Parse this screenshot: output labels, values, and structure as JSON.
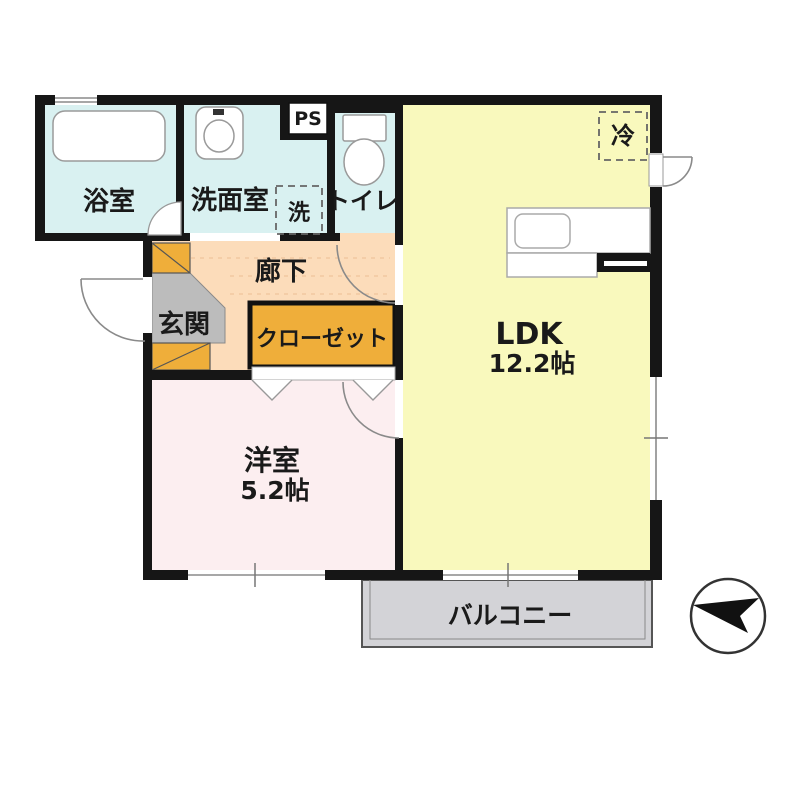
{
  "plan": {
    "rooms": {
      "bath": {
        "label": "浴室"
      },
      "washroom": {
        "label": "洗面室"
      },
      "laundry": {
        "label": "洗"
      },
      "pipe_space": {
        "label": "PS"
      },
      "toilet": {
        "label": "トイレ"
      },
      "refrigerator": {
        "label": "冷"
      },
      "ldk": {
        "label": "LDK",
        "size": "12.2帖"
      },
      "hallway": {
        "label": "廊下"
      },
      "entrance": {
        "label": "玄関"
      },
      "closet": {
        "label": "クローゼット"
      },
      "western_room": {
        "label": "洋室",
        "size": "5.2帖"
      },
      "balcony": {
        "label": "バルコニー"
      }
    },
    "colors": {
      "wet_area": "#d9f1f1",
      "ldk": "#f9f9bd",
      "hallway": "#fcdcba",
      "entrance": "#bcbcbc",
      "shoebox": "#efae3a",
      "closet": "#efae3a",
      "western_room": "#fceef0",
      "balcony": "#d3d3d7",
      "wall": "#161616"
    }
  }
}
